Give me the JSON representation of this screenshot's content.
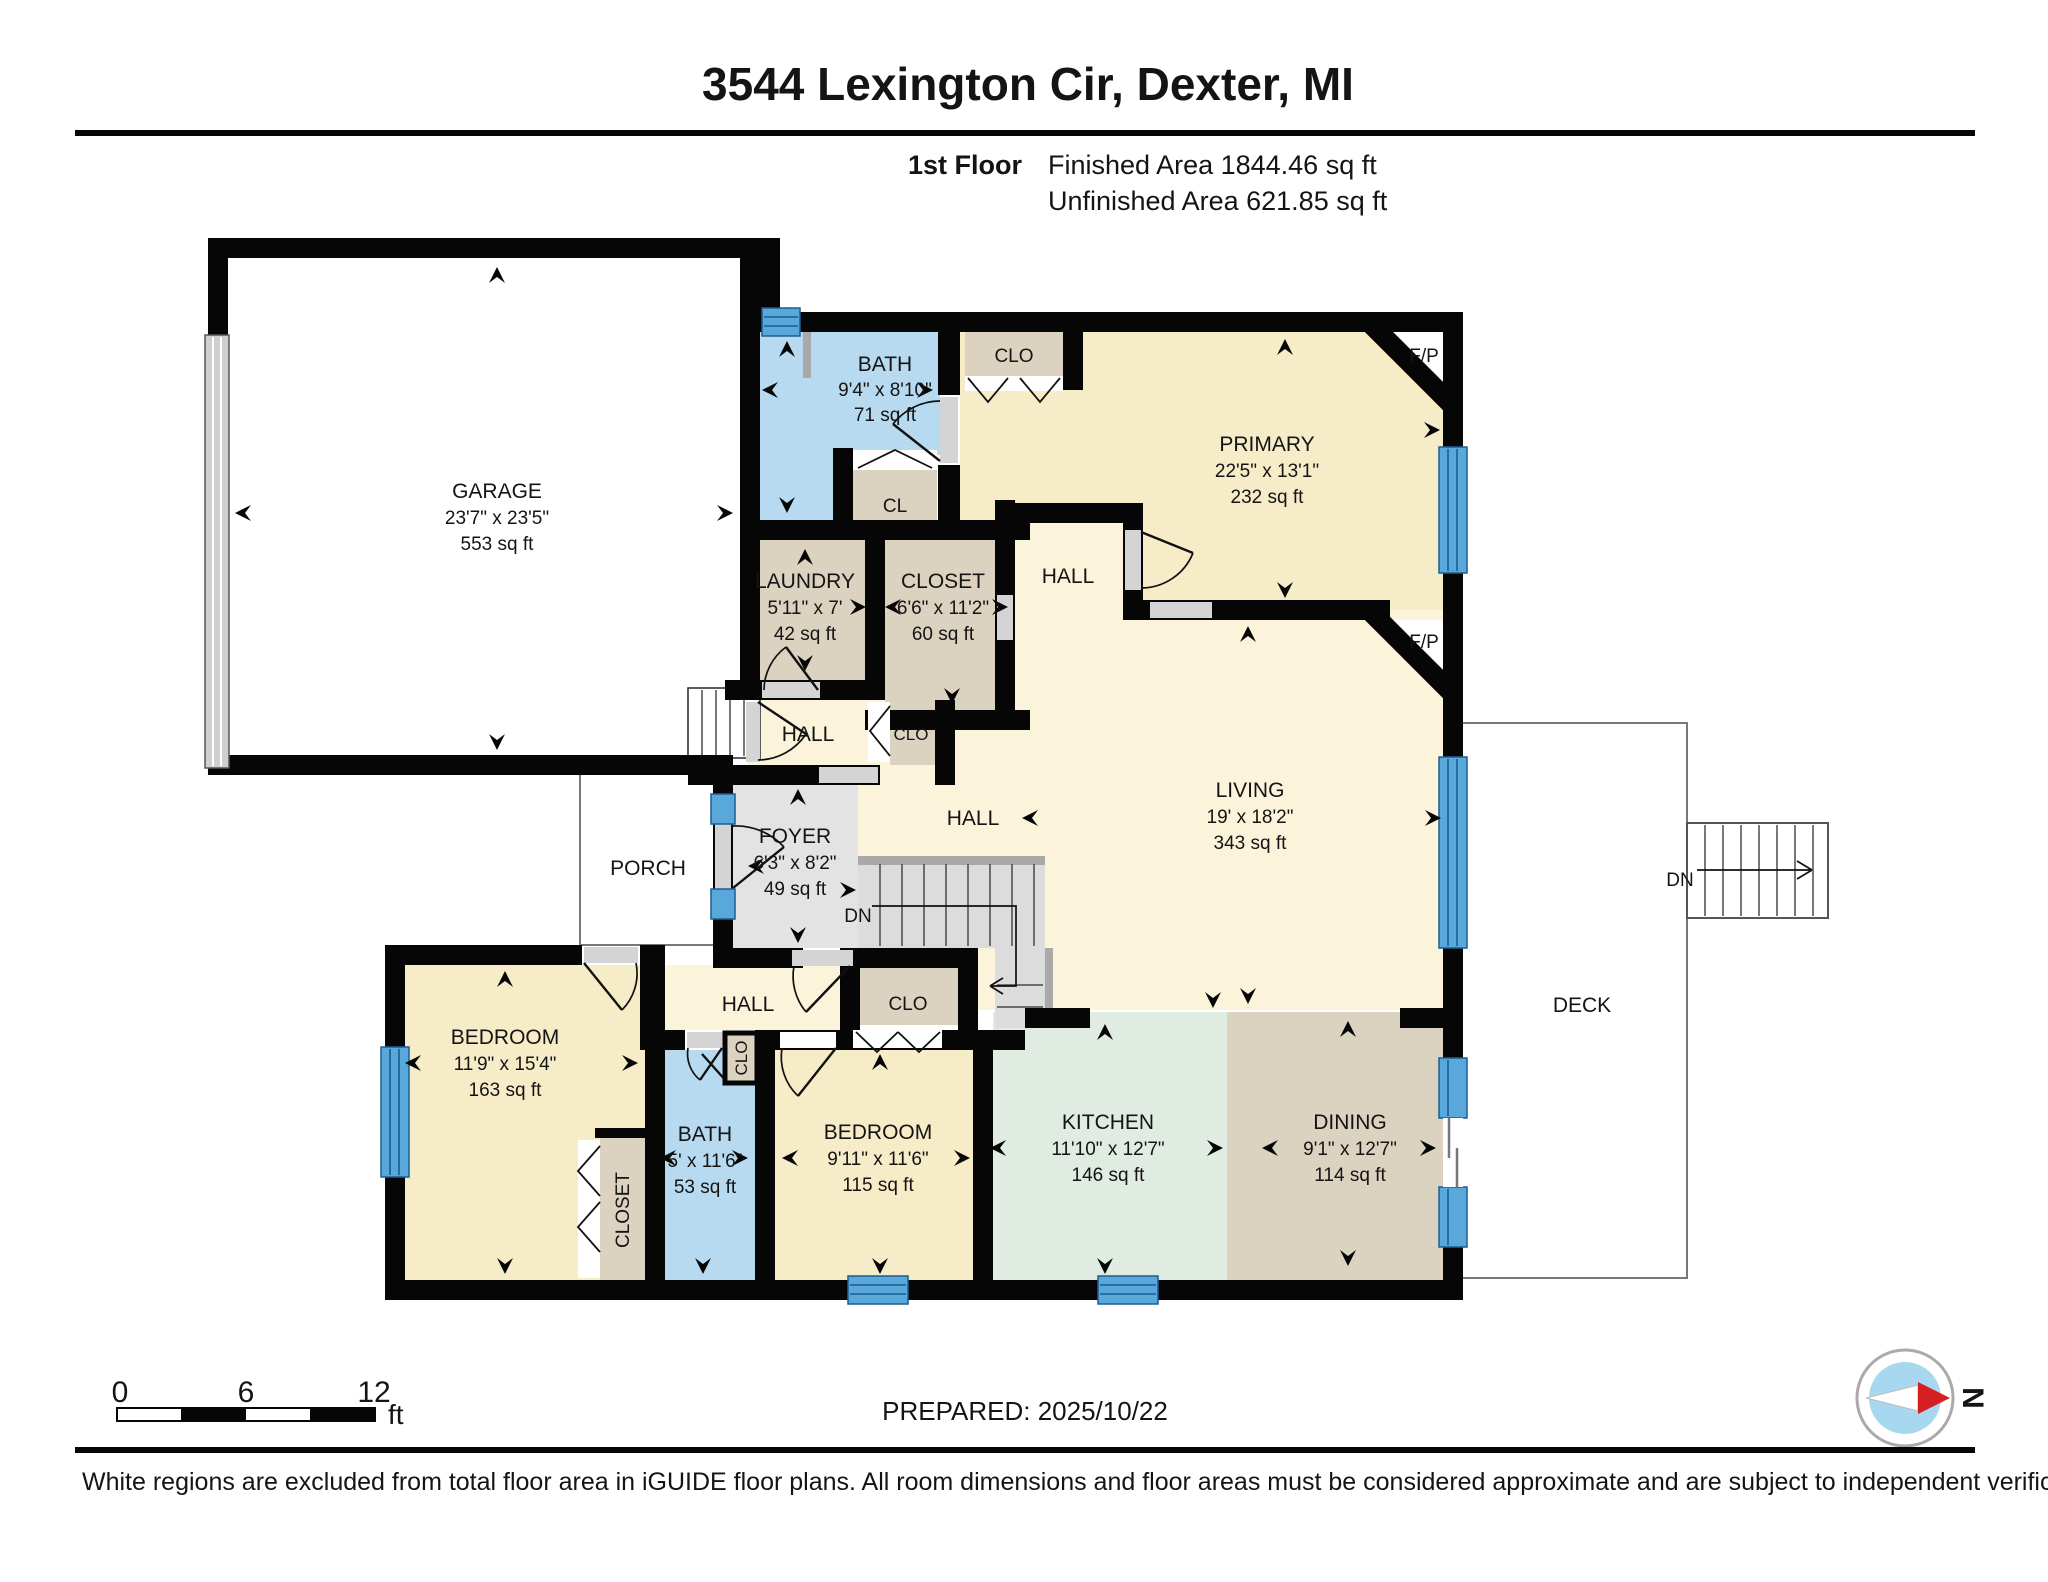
{
  "header": {
    "title": "3544 Lexington Cir, Dexter, MI",
    "floor_label": "1st Floor",
    "finished": "Finished Area 1844.46 sq ft",
    "unfinished": "Unfinished Area 621.85 sq ft"
  },
  "rooms": {
    "garage": {
      "name": "GARAGE",
      "dims": "23'7\" x 23'5\"",
      "area": "553 sq ft"
    },
    "bath1": {
      "name": "BATH",
      "dims": "9'4\" x 8'10\"",
      "area": "71 sq ft"
    },
    "clo_top": {
      "name": "CLO"
    },
    "cl": {
      "name": "CL"
    },
    "primary": {
      "name": "PRIMARY",
      "dims": "22'5\" x 13'1\"",
      "area": "232 sq ft"
    },
    "fp_primary": {
      "name": "F/P"
    },
    "fp_living": {
      "name": "F/P"
    },
    "hall_primary": {
      "name": "HALL"
    },
    "laundry": {
      "name": "LAUNDRY",
      "dims": "5'11\" x 7'",
      "area": "42 sq ft"
    },
    "closet_mid": {
      "name": "CLOSET",
      "dims": "6'6\" x 11'2\"",
      "area": "60 sq ft"
    },
    "hall_small": {
      "name": "HALL"
    },
    "clo_small": {
      "name": "CLO"
    },
    "living": {
      "name": "LIVING",
      "dims": "19' x 18'2\"",
      "area": "343 sq ft"
    },
    "hall_living": {
      "name": "HALL"
    },
    "foyer": {
      "name": "FOYER",
      "dims": "6'3\" x 8'2\"",
      "area": "49 sq ft"
    },
    "porch": {
      "name": "PORCH"
    },
    "stairs_dn": {
      "label": "DN"
    },
    "hall_bottom": {
      "name": "HALL"
    },
    "clo_bottom": {
      "name": "CLO"
    },
    "bedroom1": {
      "name": "BEDROOM",
      "dims": "11'9\" x 15'4\"",
      "area": "163 sq ft"
    },
    "closet_bedroom1": {
      "name": "CLOSET"
    },
    "bath2": {
      "name": "BATH",
      "dims": "5' x 11'6\"",
      "area": "53 sq ft"
    },
    "clo_bath2": {
      "name": "CLO"
    },
    "bedroom2": {
      "name": "BEDROOM",
      "dims": "9'11\" x 11'6\"",
      "area": "115 sq ft"
    },
    "kitchen": {
      "name": "KITCHEN",
      "dims": "11'10\" x 12'7\"",
      "area": "146 sq ft"
    },
    "dining": {
      "name": "DINING",
      "dims": "9'1\" x 12'7\"",
      "area": "114 sq ft"
    },
    "deck": {
      "name": "DECK"
    },
    "deck_stairs": {
      "label": "DN"
    }
  },
  "scale_bar": {
    "t0": "0",
    "t6": "6",
    "t12": "12",
    "unit": "ft"
  },
  "compass": {
    "north": "N"
  },
  "footer": {
    "prepared": "PREPARED: 2025/10/22",
    "disclaimer": "White regions are excluded from total floor area in iGUIDE floor plans. All room dimensions and floor areas must be considered approximate and are subject to independent verification."
  },
  "colors": {
    "wall": "#060606",
    "room_cream": "#f7ecc8",
    "hall_cream": "#fbf3da",
    "closet_tan": "#dcd2c0",
    "bath_blue": "#b7daf1",
    "kitchen_mint": "#e0ebe2",
    "foyer_gray": "#e3e3e3",
    "window_blue": "#58a8dc",
    "compass_red": "#d42020",
    "compass_blue": "#a8d8f0"
  }
}
